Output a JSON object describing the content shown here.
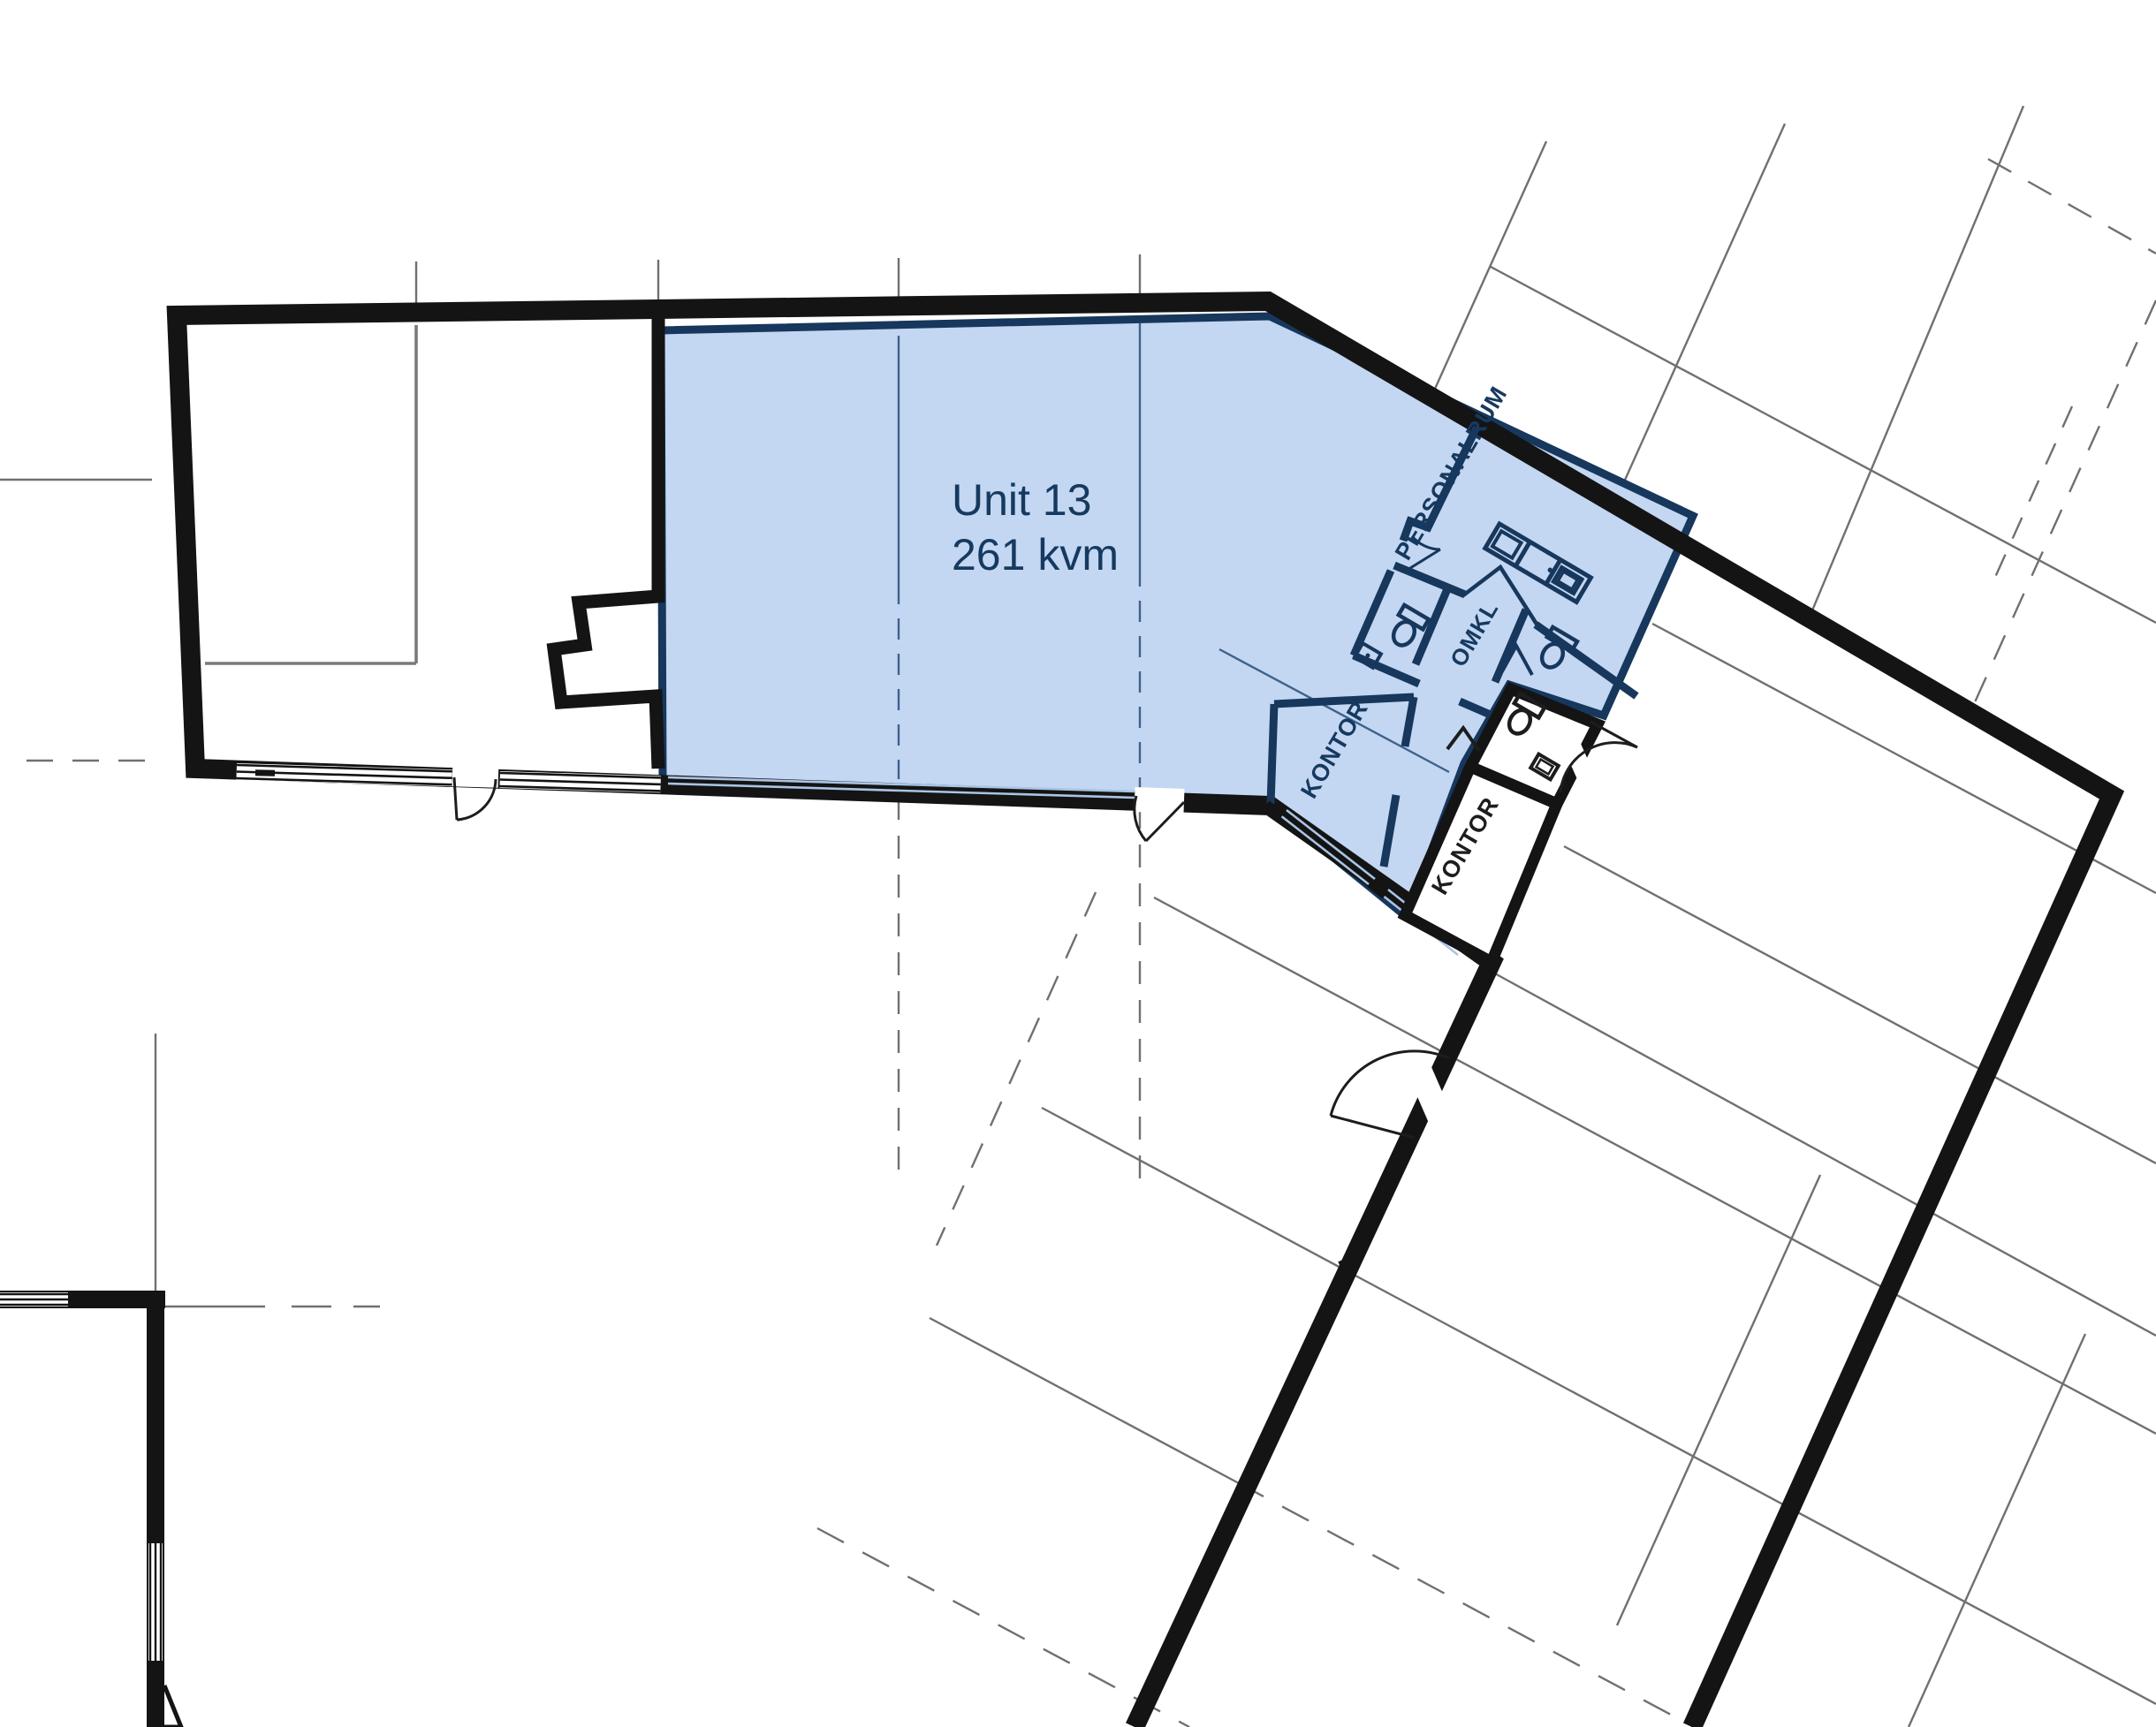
{
  "plan": {
    "unit": {
      "name": "Unit 13",
      "area": "261 kvm"
    },
    "rooms": [
      {
        "label": "PERSONALRUM",
        "zone": "highlighted-unit"
      },
      {
        "label": "OMKL",
        "zone": "highlighted-unit"
      },
      {
        "label": "KONTOR",
        "zone": "highlighted-unit"
      },
      {
        "label": "KONTOR",
        "zone": "outside-unit"
      }
    ],
    "colors": {
      "highlight_fill": "#c3d7f2",
      "highlight_border": "#17375c",
      "wall": "#141414",
      "gridline": "#707070",
      "grid_in_highlight": "#3f618b",
      "glazing": "#a9c4e4",
      "label_navy": "#16395f",
      "label_dark": "#1d1d1d",
      "background": "#ffffff"
    }
  }
}
